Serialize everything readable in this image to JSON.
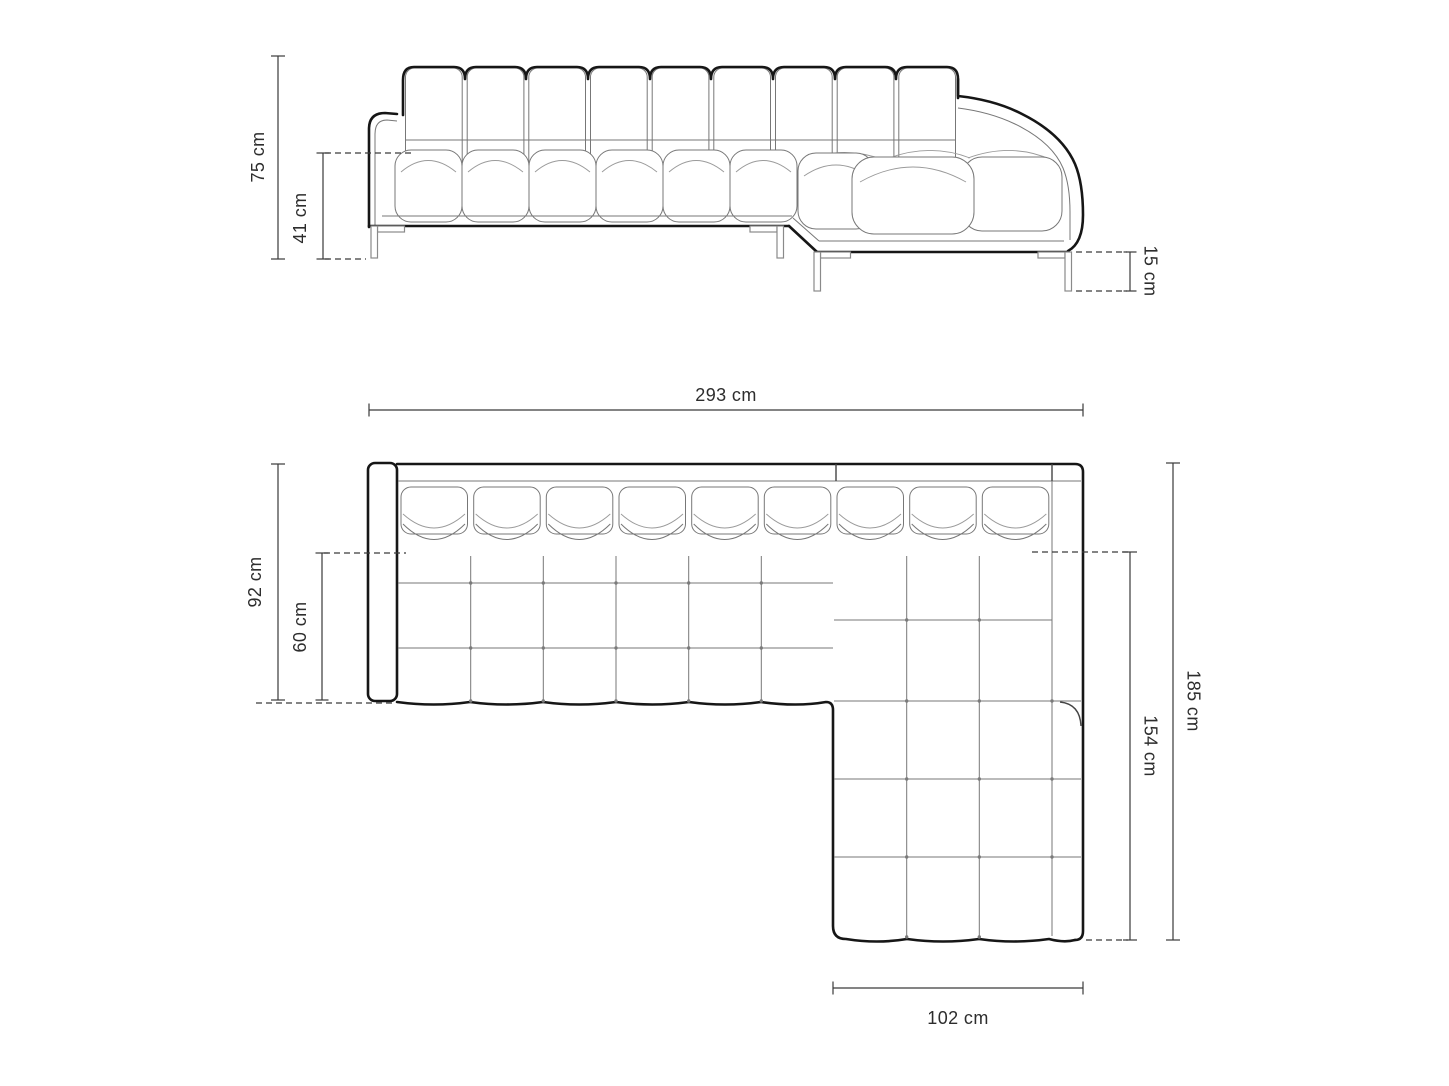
{
  "units": "cm",
  "colors": {
    "background": "#ffffff",
    "outline": "#161616",
    "seam": "#777777",
    "dimension_line": "#3a3a3a",
    "label_text": "#2d2d2d"
  },
  "front_view": {
    "total_height": {
      "label": "75 cm",
      "value": 75
    },
    "seat_height": {
      "label": "41 cm",
      "value": 41
    },
    "leg_height": {
      "label": "15 cm",
      "value": 15
    }
  },
  "plan_view": {
    "total_width": {
      "label": "293 cm",
      "value": 293
    },
    "total_depth": {
      "label": "92 cm",
      "value": 92
    },
    "seat_depth": {
      "label": "60 cm",
      "value": 60
    },
    "total_length": {
      "label": "185 cm",
      "value": 185
    },
    "chaise_length": {
      "label": "154 cm",
      "value": 154
    },
    "chaise_width": {
      "label": "102 cm",
      "value": 102
    }
  }
}
